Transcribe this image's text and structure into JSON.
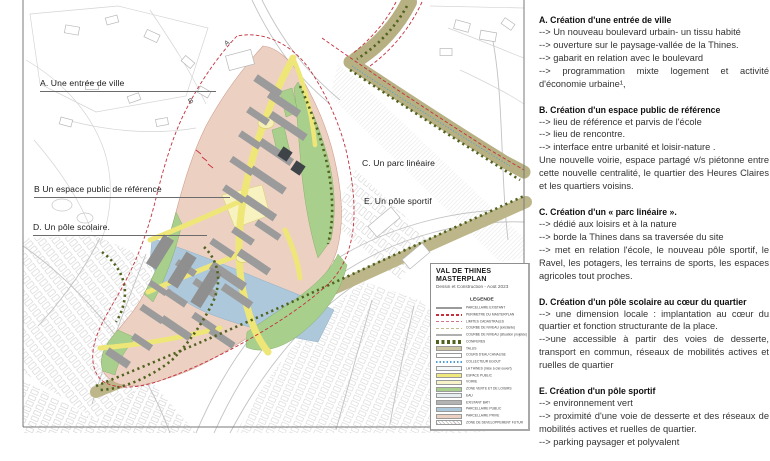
{
  "map": {
    "labels": [
      {
        "id": "A",
        "text": "A. Une entrée de ville"
      },
      {
        "id": "B",
        "text": "B Un espace public de référence"
      },
      {
        "id": "C",
        "text": "C. Un parc linéaire"
      },
      {
        "id": "D",
        "text": "D. Un pôle scolaire."
      },
      {
        "id": "E",
        "text": "E. Un pôle sportif"
      }
    ],
    "markers": [
      {
        "text": "A."
      },
      {
        "text": "B"
      }
    ],
    "colors": {
      "parcel_private_pink": "#ecd1c3",
      "parcel_public_blue": "#adc8da",
      "green_zone": "#a9cf8d",
      "road_yellow": "#efe678",
      "public_space_pale_yellow": "#f7f2c0",
      "talus_olive": "#b7b083",
      "building_gray": "#9b9b9b",
      "perimeter_red": "#c5303c",
      "tree_line_dark_green": "#51621f",
      "cadastre_gray": "#c9c9c9"
    }
  },
  "legend": {
    "title_line1": "VAL DE THINES",
    "title_line2": "MASTERPLAN",
    "subtitle": "Dessin et Construction - Août 2023",
    "header": "LEGENDE",
    "items": [
      {
        "label": "PARCELLAIRE EXISTANT",
        "swatch": "line",
        "color": "#9a9a9a"
      },
      {
        "label": "PERIMETRE DU MASTERPLAN",
        "swatch": "dash",
        "color": "#c5303c"
      },
      {
        "label": "LIMITES CADASTRALES",
        "swatch": "dash",
        "color": "#d4728c"
      },
      {
        "label": "COURBE DE NIVEAU (existante)",
        "swatch": "dash",
        "color": "#c3bb94"
      },
      {
        "label": "COURBE DE NIVEAU (situation projetée)",
        "swatch": "line",
        "color": "#b0b0b0"
      },
      {
        "label": "CONIFERES",
        "swatch": "dots",
        "color": "#51621f"
      },
      {
        "label": "TALUS",
        "swatch": "fill",
        "color": "#cdc6a0"
      },
      {
        "label": "COURS D'EAU CANALISE",
        "swatch": "fill",
        "color": "#ffffff"
      },
      {
        "label": "COLLECTEUR EGOUT",
        "swatch": "dotline",
        "color": "#4f9fd4"
      },
      {
        "label": "LA THINES (mise à ciel ouvert)",
        "swatch": "fill",
        "color": "#f4fafc"
      },
      {
        "label": "ESPACE PUBLIC",
        "swatch": "fill",
        "color": "#f0e87c"
      },
      {
        "label": "VOIRIE",
        "swatch": "fill",
        "color": "#f7f3c8"
      },
      {
        "label": "ZONE VERTE ET DE LOISIRS",
        "swatch": "fill",
        "color": "#a9cf8d"
      },
      {
        "label": "EAU",
        "swatch": "fill",
        "color": "#e6eef2"
      },
      {
        "label": "EXISTANT BATI",
        "swatch": "fill",
        "color": "#b3b3b3"
      },
      {
        "label": "PARCELLAIRE PUBLIC",
        "swatch": "fill",
        "color": "#adc8da"
      },
      {
        "label": "PARCELLAIRE PRIVE",
        "swatch": "fill",
        "color": "#ecd1c3"
      },
      {
        "label": "ZONE DE DEVELOPPEMENT FUTUR",
        "swatch": "hatch",
        "color": "#bdbdbd"
      }
    ]
  },
  "sections": [
    {
      "heading": "A. Création d'une entrée de ville",
      "lines": [
        "--> Un nouveau boulevard urbain- un tissu habité",
        "--> ouverture sur le paysage-vallée de la Thines.",
        "--> gabarit en relation avec le boulevard",
        "--> programmation mixte logement et activité d'économie urbaine¹,"
      ]
    },
    {
      "heading": "B. Création d'un espace public de référence",
      "lines": [
        "--> lieu de référence et parvis de l'école",
        "--> lieu de rencontre.",
        "--> interface entre urbanité et loisir-nature .",
        "Une nouvelle voirie, espace partagé v/s piétonne entre cette nouvelle centralité, le quartier des Heures Claires et les quartiers voisins."
      ]
    },
    {
      "heading": "C. Création d'un « parc linéaire ».",
      "lines": [
        "--> dédié aux loisirs et à la nature",
        "--> borde la Thines dans sa traversée du site",
        "--> met en relation l'école, le nouveau pôle sportif, le Ravel, les potagers, les terrains de sports, les espaces agricoles tout proches."
      ]
    },
    {
      "heading": "D. Création d'un pôle scolaire au cœur du quartier",
      "lines": [
        "--> une dimension locale : implantation au cœur du quartier et fonction structurante de la place.",
        "-->une accessible à partir des voies de desserte, transport en commun, réseaux de mobilités actives et ruelles de quartier"
      ]
    },
    {
      "heading": "E. Création d'un pôle sportif",
      "lines": [
        "--> environnement vert",
        "--> proximité d'une voie de desserte et des réseaux de mobilités actives et ruelles de quartier.",
        "--> parking paysager et polyvalent"
      ]
    }
  ]
}
